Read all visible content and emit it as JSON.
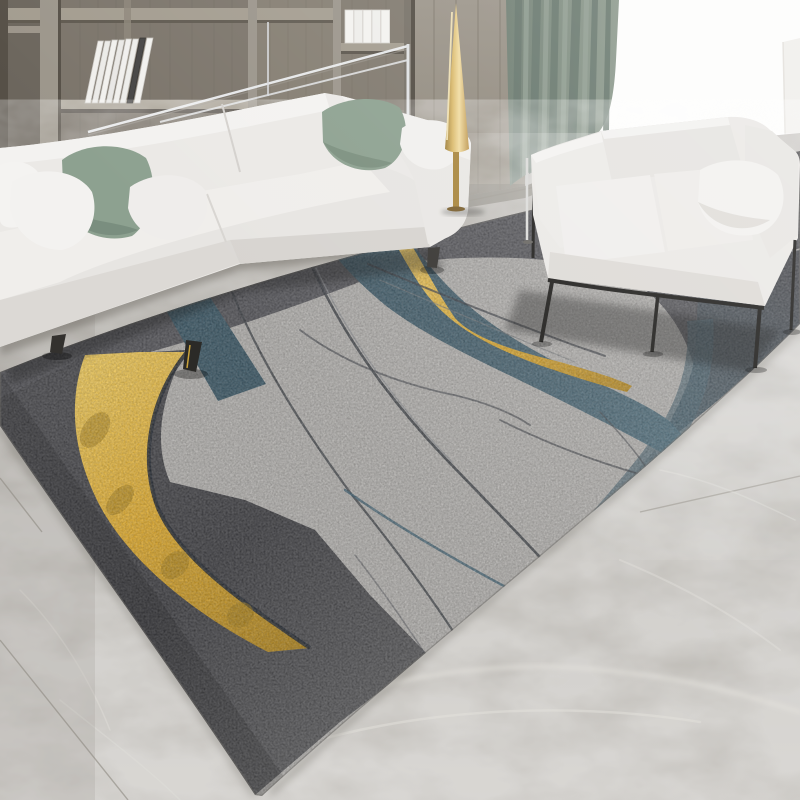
{
  "scene": {
    "description_label": "modern living room with abstract area rug",
    "objects": {
      "shelving_unit": {
        "name": "wood-shelving-unit",
        "leaning_books_count": 8,
        "stacked_books_count": 5
      },
      "floor_lamp": {
        "name": "gold-cone-floor-lamp"
      },
      "curtain": {
        "name": "sage-green-curtain"
      },
      "window": {
        "name": "bright-window-light"
      },
      "sofa_large": {
        "name": "white-three-seat-sofa",
        "pillow_colors": [
          "white",
          "sage-green",
          "white",
          "sage-green",
          "white"
        ]
      },
      "sofa_small": {
        "name": "white-loveseat-black-metal-frame",
        "pillow_colors": [
          "white"
        ]
      },
      "rug": {
        "name": "abstract-gray-gold-blue-area-rug",
        "bands": [
          "charcoal-top-band",
          "charcoal-left-band",
          "charcoal-right-band",
          "gold-curved-stripe",
          "gold-ribbon-line",
          "steel-blue-band-small",
          "steel-blue-band-large",
          "thin-crack-lines",
          "thin-blue-lines"
        ]
      },
      "floor": {
        "name": "gray-marble-tile-floor"
      },
      "metal_rail": {
        "name": "chrome-rail-frame"
      }
    }
  },
  "palette": {
    "wall-wood": "#8d867b",
    "wall-wood-dark": "#6b655c",
    "wall-wood-light": "#a39c8f",
    "panel-wood": "#9a9388",
    "curtain-green": "#7e8c7f",
    "curtain-green-dark": "#64746a",
    "window-white": "#fdfdfc",
    "marble-light": "#c4c1bc",
    "marble-mid": "#b0ada7",
    "marble-dark": "#8e8a82",
    "rug-field": "#b4b2af",
    "rug-top-band": "#55555a",
    "rug-charcoal": "#3f3f43",
    "rug-blue": "#45616f",
    "rug-gold": "#e0ab2e",
    "rug-gold-bright": "#f2cd5e",
    "navy-line": "#252a33",
    "crack-gray": "#3b3e44",
    "sofa-white": "#ebe9e6",
    "sofa-shade": "#dcd9d5",
    "pillow-sage": "#8da190",
    "frame-black": "#242321",
    "chrome": "#e8eaec",
    "lamp-brass": "#d9b96b"
  }
}
